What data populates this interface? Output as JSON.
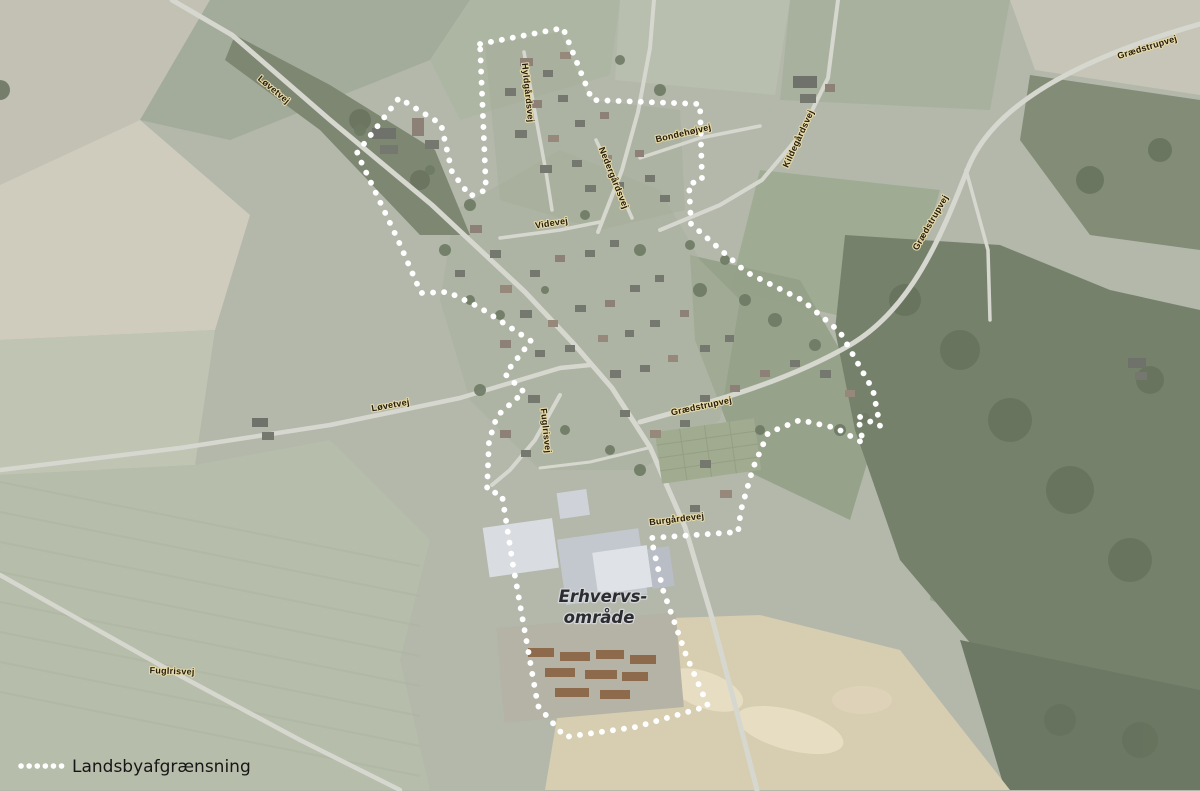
{
  "legend": {
    "label": "Landsbyafgrænsning"
  },
  "area_label": {
    "line1": "Erhvervs-",
    "line2": "område"
  },
  "road_labels": [
    {
      "text": "Løvetvej",
      "x": 272,
      "y": 92,
      "rot": 40
    },
    {
      "text": "Grædstrupvej",
      "x": 1148,
      "y": 50,
      "rot": -17
    },
    {
      "text": "Hyldgårdsvej",
      "x": 525,
      "y": 93,
      "rot": 84
    },
    {
      "text": "Nedergårdsvej",
      "x": 611,
      "y": 179,
      "rot": 68
    },
    {
      "text": "Bondehøjvej",
      "x": 684,
      "y": 136,
      "rot": -13
    },
    {
      "text": "Kildegårdsvej",
      "x": 801,
      "y": 140,
      "rot": -65
    },
    {
      "text": "Grædstrupvej",
      "x": 933,
      "y": 224,
      "rot": -60
    },
    {
      "text": "Videvej",
      "x": 552,
      "y": 226,
      "rot": -9
    },
    {
      "text": "Løvetvej",
      "x": 391,
      "y": 408,
      "rot": -10
    },
    {
      "text": "Grædstrupvej",
      "x": 702,
      "y": 409,
      "rot": -12
    },
    {
      "text": "Fuglrisvej",
      "x": 543,
      "y": 431,
      "rot": 84
    },
    {
      "text": "Burgårdevej",
      "x": 677,
      "y": 522,
      "rot": -7
    },
    {
      "text": "Fuglrisvej",
      "x": 172,
      "y": 674,
      "rot": 2
    }
  ],
  "boundary": {
    "name": "Landsbyafgrænsning",
    "color": "#ffffff",
    "points": [
      [
        480,
        44
      ],
      [
        563,
        28
      ],
      [
        592,
        100
      ],
      [
        700,
        104
      ],
      [
        702,
        180
      ],
      [
        689,
        184
      ],
      [
        691,
        224
      ],
      [
        746,
        272
      ],
      [
        802,
        300
      ],
      [
        840,
        332
      ],
      [
        873,
        390
      ],
      [
        880,
        426
      ],
      [
        858,
        416
      ],
      [
        863,
        443
      ],
      [
        836,
        428
      ],
      [
        800,
        420
      ],
      [
        768,
        433
      ],
      [
        753,
        468
      ],
      [
        741,
        510
      ],
      [
        738,
        532
      ],
      [
        651,
        538
      ],
      [
        663,
        590
      ],
      [
        686,
        655
      ],
      [
        708,
        706
      ],
      [
        636,
        727
      ],
      [
        565,
        737
      ],
      [
        538,
        706
      ],
      [
        513,
        565
      ],
      [
        502,
        495
      ],
      [
        487,
        490
      ],
      [
        489,
        441
      ],
      [
        497,
        416
      ],
      [
        524,
        392
      ],
      [
        505,
        374
      ],
      [
        531,
        341
      ],
      [
        479,
        307
      ],
      [
        448,
        292
      ],
      [
        421,
        293
      ],
      [
        398,
        240
      ],
      [
        357,
        153
      ],
      [
        399,
        98
      ],
      [
        441,
        124
      ],
      [
        452,
        172
      ],
      [
        470,
        196
      ],
      [
        486,
        190
      ]
    ]
  },
  "style": {
    "boundary_color": "#ffffff",
    "label_fill": "#241c0c",
    "label_halo": "#e6d9a8",
    "area_label_fill": "#2b2b30",
    "area_label_halo": "#d3d6d8",
    "legend_text_color": "#161616"
  }
}
